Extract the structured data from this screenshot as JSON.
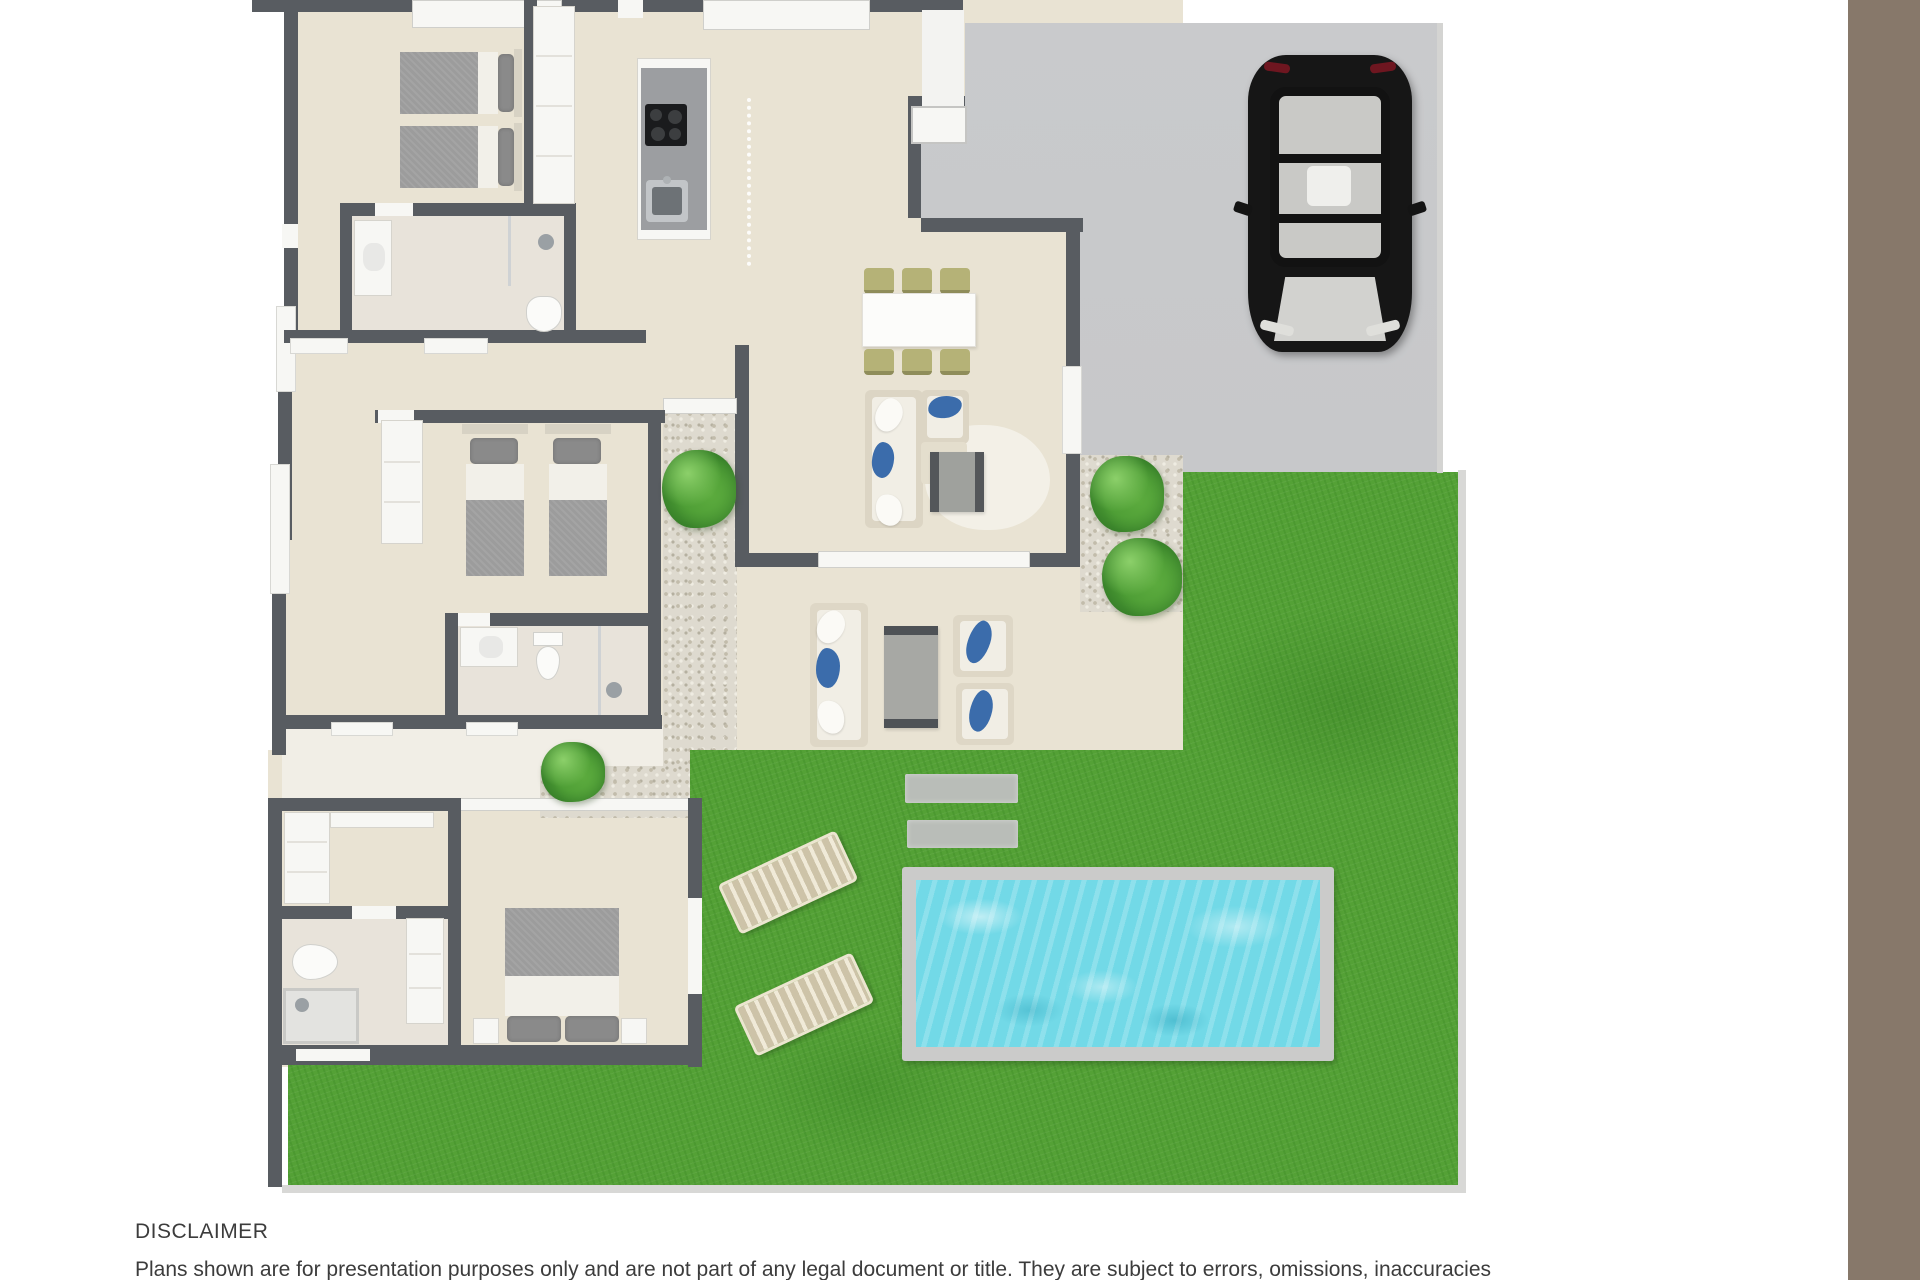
{
  "disclaimer": {
    "title": "DISCLAIMER",
    "body": "Plans shown are for presentation purposes only and are not part of any legal document or title. They are subject to errors, omissions, inaccuracies"
  },
  "plan": {
    "type": "3d-top-down-floor-plan",
    "objects": [
      "three bedrooms with beds",
      "three bathrooms",
      "kitchen island with cooktop and sink",
      "dining table with six chairs",
      "indoor lounge sofa with coffee table",
      "outdoor patio sofa set with two armchairs and table",
      "driveway with black car",
      "lawn",
      "swimming pool",
      "two sun loungers",
      "two stepping stones",
      "four garden bushes"
    ]
  },
  "colors": {
    "brown_bar": "#87786a",
    "wall": "#585c61",
    "floor": "#e9e3d3",
    "floor_soft": "#e8e3da",
    "white_trim": "#f7f7f4",
    "driveway": "#c6c7c9",
    "gravel": "#dedacf",
    "grass": "#54a136",
    "pool_water": "#72d9e7",
    "pool_coping": "#cbcbca",
    "bush": "#4a9a33",
    "car_body": "#161616",
    "sofa_cream": "#dcd5c4",
    "cushion_white": "#f1eee5",
    "pillow_blue": "#3b6cab",
    "chair_olive": "#b5b277",
    "stone_gray": "#b9bdb8",
    "lounger_slat": "#cdc3a8",
    "lounger_frame": "#ece5d0",
    "bed_blanket": "#9c9c9c",
    "bed_pillow": "#8a8a8a",
    "bed_sheet": "#f2f0e9",
    "island_gray": "#9c9ea1",
    "table_gray": "#a7a8a4",
    "text": "#3c3c3c"
  }
}
